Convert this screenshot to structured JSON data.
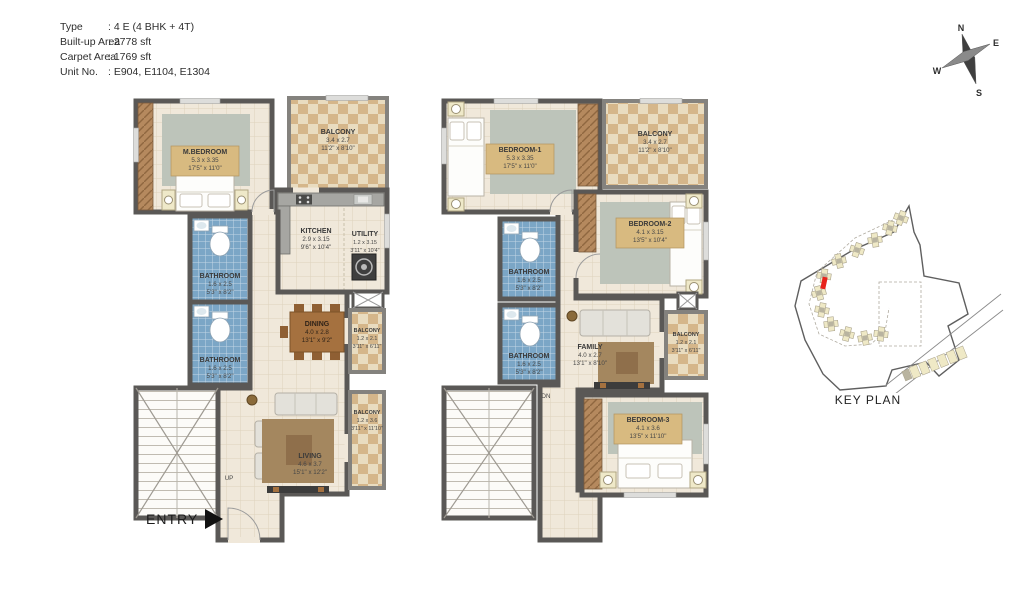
{
  "info": {
    "rows": [
      {
        "label": "Type",
        "value": ": 4 E (4 BHK + 4T)"
      },
      {
        "label": "Built-up Area",
        "value": ": 2778 sft"
      },
      {
        "label": "Carpet Area",
        "value": ": 1769 sft"
      },
      {
        "label": "Unit No.",
        "value": ": E904, E1104, E1304"
      }
    ]
  },
  "compass": {
    "n": "N",
    "e": "E",
    "w": "W",
    "s": "S"
  },
  "lower": {
    "mbedroom": {
      "name": "M.BEDROOM",
      "m": "5.3 x 3.35",
      "ft": "17'5\" x 11'0\""
    },
    "balcony_top": {
      "name": "BALCONY",
      "m": "3.4 x 2.7",
      "ft": "11'2\" x 8'10\""
    },
    "kitchen": {
      "name": "KITCHEN",
      "m": "2.9 x 3.15",
      "ft": "9'6\" x 10'4\""
    },
    "utility": {
      "name": "UTILITY",
      "m": "1.2 x 3.15",
      "ft": "3'11\" x 10'4\""
    },
    "bath1": {
      "name": "BATHROOM",
      "m": "1.6 x 2.5",
      "ft": "5'3\" x 8'2\""
    },
    "bath2": {
      "name": "BATHROOM",
      "m": "1.6 x 2.5",
      "ft": "5'3\" x 8'2\""
    },
    "dining": {
      "name": "DINING",
      "m": "4.0 x 2.8",
      "ft": "13'1\" x 9'2\""
    },
    "balcony_mid": {
      "name": "BALCONY",
      "m": "1.2 x 2.1",
      "ft": "3'11\" x 6'11\""
    },
    "living": {
      "name": "LIVING",
      "m": "4.6 x 3.7",
      "ft": "15'1\" x 12'2\""
    },
    "balcony_bottom": {
      "name": "BALCONY",
      "m": "1.2 x 3.6",
      "ft": "3'11\" x 11'10\""
    },
    "stair_label": "UP",
    "entry_label": "ENTRY"
  },
  "upper": {
    "bedroom1": {
      "name": "BEDROOM-1",
      "m": "5.3 x 3.35",
      "ft": "17'5\" x 11'0\""
    },
    "balcony_top": {
      "name": "BALCONY",
      "m": "3.4 x 2.7",
      "ft": "11'2\" x 8'10\""
    },
    "bedroom2": {
      "name": "BEDROOM-2",
      "m": "4.1 x 3.15",
      "ft": "13'5\" x 10'4\""
    },
    "bath1": {
      "name": "BATHROOM",
      "m": "1.6 x 2.5",
      "ft": "5'3\" x 8'2\""
    },
    "bath2": {
      "name": "BATHROOM",
      "m": "1.6 x 2.5",
      "ft": "5'3\" x 8'2\""
    },
    "family": {
      "name": "FAMILY",
      "m": "4.0 x 2.7",
      "ft": "13'1\" x 8'10\""
    },
    "balcony_mid": {
      "name": "BALCONY",
      "m": "1.2 x 2.1",
      "ft": "3'11\" x 6'11\""
    },
    "bedroom3": {
      "name": "BEDROOM-3",
      "m": "4.1 x 3.6",
      "ft": "13'5\" x 11'10\""
    },
    "stair_label": "DN"
  },
  "key_plan": {
    "label": "KEY PLAN"
  },
  "colors": {
    "wall": "#5a5856",
    "floor": "#f0e8da",
    "bath_tile": "#7ba6c6",
    "balcony_tile": "#d5b68a",
    "wood": "#b5895e",
    "rug_green": "#bdc4ba",
    "rug_brown": "#a4875f",
    "accent_red": "#e8231c",
    "label_chip": "#d8ba80"
  }
}
